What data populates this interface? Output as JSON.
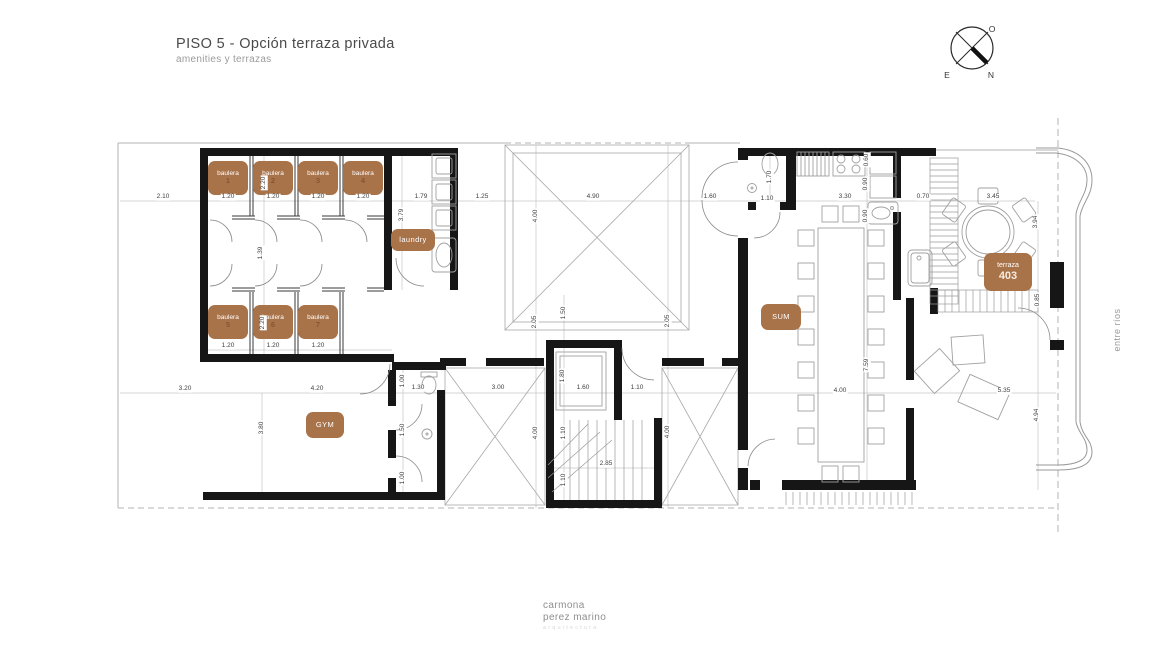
{
  "header": {
    "title": "PISO 5 - Opción terraza privada",
    "subtitle": "amenities y terrazas"
  },
  "compass": {
    "o_label": "O",
    "e_label": "E",
    "n_label": "N"
  },
  "side_label": "entre ríos",
  "footer": {
    "line1": "carmona",
    "line2": "perez marino",
    "line3": "arquitectura"
  },
  "colors": {
    "badge": "#a9734a",
    "badge_number": "#875433",
    "wall": "#161616",
    "thin_line": "#a8a8a8",
    "dim_text": "#3f3f3f"
  },
  "plan": {
    "rooms": [
      {
        "label": "baulera",
        "num": "1",
        "x": 228,
        "y": 178,
        "w": 40,
        "h": 34
      },
      {
        "label": "baulera",
        "num": "2",
        "x": 273,
        "y": 178,
        "w": 40,
        "h": 34
      },
      {
        "label": "baulera",
        "num": "3",
        "x": 318,
        "y": 178,
        "w": 40,
        "h": 34
      },
      {
        "label": "baulera",
        "num": "4",
        "x": 363,
        "y": 178,
        "w": 40,
        "h": 34
      },
      {
        "label": "laundry",
        "num": "",
        "x": 413,
        "y": 240,
        "w": 44,
        "h": 22,
        "solo": true
      },
      {
        "label": "baulera",
        "num": "5",
        "x": 228,
        "y": 322,
        "w": 40,
        "h": 34
      },
      {
        "label": "baulera",
        "num": "6",
        "x": 273,
        "y": 322,
        "w": 40,
        "h": 34
      },
      {
        "label": "baulera",
        "num": "7",
        "x": 318,
        "y": 322,
        "w": 40,
        "h": 34
      },
      {
        "label": "GYM",
        "num": "",
        "x": 325,
        "y": 425,
        "w": 38,
        "h": 26,
        "solo": true
      },
      {
        "label": "SUM",
        "num": "",
        "x": 781,
        "y": 317,
        "w": 40,
        "h": 26,
        "solo": true
      },
      {
        "label": "terraza",
        "num": "403",
        "x": 1008,
        "y": 272,
        "w": 48,
        "h": 38,
        "big": true
      }
    ],
    "dimensions": [
      {
        "t": "2.10",
        "x": 163,
        "y": 197,
        "o": "h"
      },
      {
        "t": "1.20",
        "x": 228,
        "y": 197,
        "o": "h"
      },
      {
        "t": "1.20",
        "x": 273,
        "y": 197,
        "o": "h"
      },
      {
        "t": "1.20",
        "x": 318,
        "y": 197,
        "o": "h"
      },
      {
        "t": "1.20",
        "x": 363,
        "y": 197,
        "o": "h"
      },
      {
        "t": "1.79",
        "x": 421,
        "y": 197,
        "o": "h"
      },
      {
        "t": "1.25",
        "x": 482,
        "y": 197,
        "o": "h"
      },
      {
        "t": "4.90",
        "x": 593,
        "y": 197,
        "o": "h"
      },
      {
        "t": "1.60",
        "x": 710,
        "y": 197,
        "o": "h"
      },
      {
        "t": "1.10",
        "x": 767,
        "y": 199,
        "o": "h"
      },
      {
        "t": "3.30",
        "x": 845,
        "y": 197,
        "o": "h"
      },
      {
        "t": "0.70",
        "x": 923,
        "y": 197,
        "o": "h"
      },
      {
        "t": "3.45",
        "x": 993,
        "y": 197,
        "o": "h"
      },
      {
        "t": "1.20",
        "x": 228,
        "y": 346,
        "o": "h"
      },
      {
        "t": "1.20",
        "x": 273,
        "y": 346,
        "o": "h"
      },
      {
        "t": "1.20",
        "x": 318,
        "y": 346,
        "o": "h"
      },
      {
        "t": "3.20",
        "x": 185,
        "y": 389,
        "o": "h"
      },
      {
        "t": "4.20",
        "x": 317,
        "y": 389,
        "o": "h"
      },
      {
        "t": "1.30",
        "x": 418,
        "y": 388,
        "o": "h"
      },
      {
        "t": "3.00",
        "x": 498,
        "y": 388,
        "o": "h"
      },
      {
        "t": "1.60",
        "x": 583,
        "y": 388,
        "o": "h"
      },
      {
        "t": "1.10",
        "x": 637,
        "y": 388,
        "o": "h"
      },
      {
        "t": "4.00",
        "x": 840,
        "y": 391,
        "o": "h"
      },
      {
        "t": "5.35",
        "x": 1004,
        "y": 391,
        "o": "h"
      },
      {
        "t": "2.85",
        "x": 606,
        "y": 464,
        "o": "h"
      },
      {
        "t": "2.20",
        "x": 264,
        "y": 183,
        "o": "v"
      },
      {
        "t": "3.79",
        "x": 402,
        "y": 215,
        "o": "v"
      },
      {
        "t": "4.00",
        "x": 536,
        "y": 216,
        "o": "v"
      },
      {
        "t": "1.70",
        "x": 770,
        "y": 177,
        "o": "v"
      },
      {
        "t": "0.60",
        "x": 867,
        "y": 160,
        "o": "v"
      },
      {
        "t": "0.90",
        "x": 866,
        "y": 184,
        "o": "v"
      },
      {
        "t": "0.90",
        "x": 866,
        "y": 216,
        "o": "v"
      },
      {
        "t": "3.94",
        "x": 1036,
        "y": 222,
        "o": "v"
      },
      {
        "t": "1.39",
        "x": 261,
        "y": 253,
        "o": "v"
      },
      {
        "t": "2.20",
        "x": 263,
        "y": 323,
        "o": "v"
      },
      {
        "t": "0.85",
        "x": 1038,
        "y": 300,
        "o": "v"
      },
      {
        "t": "3.80",
        "x": 262,
        "y": 428,
        "o": "v"
      },
      {
        "t": "1.00",
        "x": 403,
        "y": 381,
        "o": "v"
      },
      {
        "t": "1.50",
        "x": 403,
        "y": 430,
        "o": "v"
      },
      {
        "t": "1.00",
        "x": 403,
        "y": 478,
        "o": "v"
      },
      {
        "t": "2.05",
        "x": 535,
        "y": 322,
        "o": "v"
      },
      {
        "t": "1.50",
        "x": 564,
        "y": 313,
        "o": "v"
      },
      {
        "t": "2.05",
        "x": 668,
        "y": 321,
        "o": "v"
      },
      {
        "t": "1.80",
        "x": 563,
        "y": 376,
        "o": "v"
      },
      {
        "t": "4.00",
        "x": 536,
        "y": 433,
        "o": "v"
      },
      {
        "t": "1.10",
        "x": 564,
        "y": 433,
        "o": "v"
      },
      {
        "t": "1.10",
        "x": 564,
        "y": 480,
        "o": "v"
      },
      {
        "t": "4.00",
        "x": 668,
        "y": 432,
        "o": "v"
      },
      {
        "t": "7.59",
        "x": 867,
        "y": 365,
        "o": "v"
      },
      {
        "t": "4.94",
        "x": 1037,
        "y": 415,
        "o": "v"
      }
    ]
  }
}
